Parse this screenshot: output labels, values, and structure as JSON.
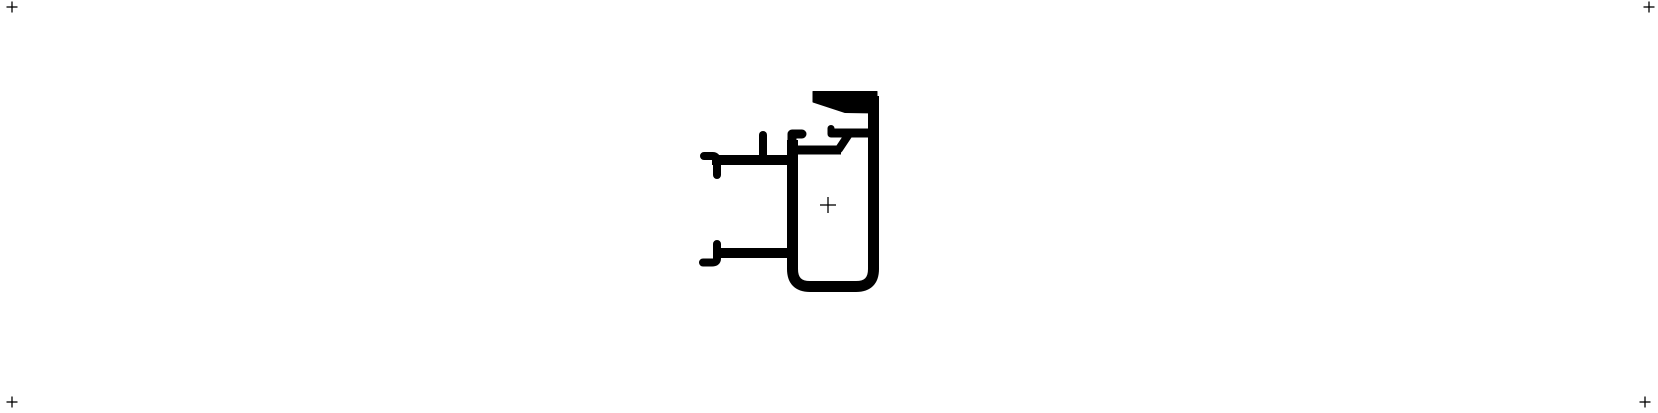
{
  "canvas": {
    "width": 1658,
    "height": 413,
    "background_color": "#ffffff",
    "ink_color": "#000000"
  },
  "registration_marks": [
    {
      "name": "top-left",
      "x": 12,
      "y": 7,
      "arm": 5.5,
      "stroke_width": 1.3
    },
    {
      "name": "top-right",
      "x": 1649,
      "y": 7,
      "arm": 5.5,
      "stroke_width": 1.3
    },
    {
      "name": "bottom-left",
      "x": 12,
      "y": 402,
      "arm": 5.5,
      "stroke_width": 1.3
    },
    {
      "name": "bottom-right",
      "x": 1645,
      "y": 402,
      "arm": 5.5,
      "stroke_width": 1.3
    }
  ],
  "center_mark": {
    "name": "profile-center",
    "x": 828,
    "y": 205,
    "arm": 8,
    "stroke_width": 1.3
  },
  "profile": {
    "description": "aluminum-extrusion-cross-section",
    "strokes": [
      {
        "name": "main-chamber-u-wall",
        "d": "M 792.5 140 L 792.5 269 Q 792.5 286.5 810 286.5 L 856 286.5 Q 873.5 286.5 873.5 269 L 873.5 96",
        "width": 11,
        "cap": "butt",
        "join": "round"
      },
      {
        "name": "left-wall-top-hook",
        "d": "M 792 152 L 792 134 L 802 134",
        "width": 9,
        "cap": "round",
        "join": "round"
      },
      {
        "name": "upper-arm-bar",
        "d": "M 712 160 L 796 160",
        "width": 10,
        "cap": "butt",
        "join": "round"
      },
      {
        "name": "upper-arm-end-hook",
        "d": "M 704 156 L 712.5 156 Q 717 156 717 161 L 717 175",
        "width": 8,
        "cap": "round",
        "join": "round"
      },
      {
        "name": "upper-mid-stub",
        "d": "M 763 157 L 763 135",
        "width": 8,
        "cap": "round",
        "join": "round"
      },
      {
        "name": "east-shelf-bar",
        "d": "M 792 150 L 841 150",
        "width": 9,
        "cap": "butt",
        "join": "round"
      },
      {
        "name": "shelf-step-diagonal",
        "d": "M 839 149 L 849 134",
        "width": 8,
        "cap": "round",
        "join": "round"
      },
      {
        "name": "inner-channel-bar",
        "d": "M 831 133 L 872 133",
        "width": 9,
        "cap": "butt",
        "join": "round"
      },
      {
        "name": "inner-channel-up-tick",
        "d": "M 831 134 L 831 128.5",
        "width": 7,
        "cap": "round",
        "join": "round"
      },
      {
        "name": "lower-arm-bar",
        "d": "M 714 253 L 796 253",
        "width": 10,
        "cap": "butt",
        "join": "round"
      },
      {
        "name": "lower-arm-end-hook",
        "d": "M 717 244 L 717 258.5 Q 717 262.5 712 262.5 L 703 262.5",
        "width": 8,
        "cap": "round",
        "join": "round"
      }
    ],
    "polygons": [
      {
        "name": "top-wedge-lip",
        "points": "813,91.5 877,91.5 877,113 845,112.5 813,102"
      }
    ]
  }
}
